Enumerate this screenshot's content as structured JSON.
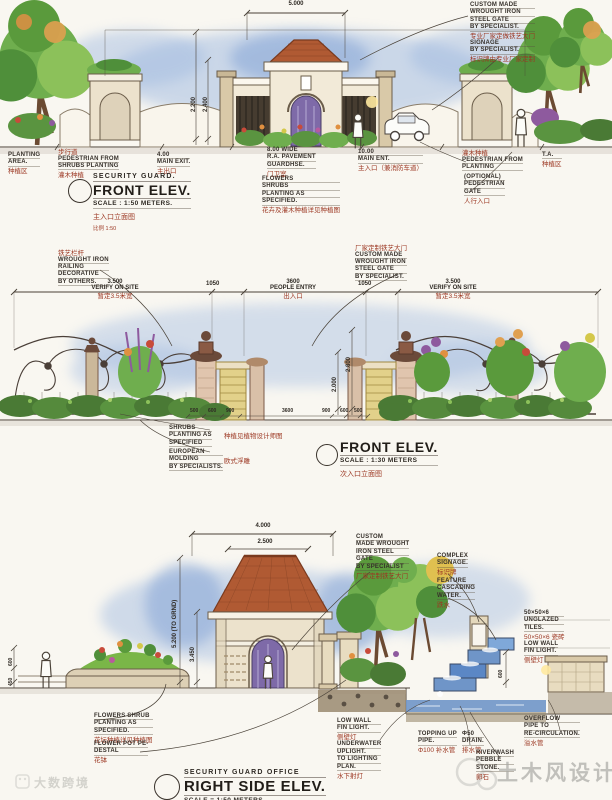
{
  "page": {
    "bg": "#f9f7f1",
    "ink": "#2f2a24",
    "cn_red": "#9c3722",
    "sky_blue": "#9db8e0",
    "roof_terracotta": "#b05a33",
    "foliage_green": "#6fae4e",
    "water_blue": "#6f95c8",
    "stone_yellow": "#e2d18a"
  },
  "watermarks": {
    "bottom_left": "大数跨境",
    "bottom_right": "土木风设计"
  },
  "elevations": [
    {
      "key": "front-elev-main-entrance",
      "title_small": "SECURITY GUARD.",
      "title": "FRONT ELEV.",
      "scale": "SCALE : 1:50 METERS.",
      "caption_cn": "主入口立面图",
      "caption_cn2": "比例 1:50",
      "dims": [
        "5.000",
        "2.200",
        "2.400"
      ],
      "annotations": [
        {
          "lines": [
            {
              "t": "PLANTING",
              "c": "en"
            },
            {
              "t": "AREA.",
              "c": "en"
            },
            {
              "t": "种植区",
              "c": "cn"
            }
          ]
        },
        {
          "lines": [
            {
              "t": "步行道",
              "c": "cn"
            },
            {
              "t": "PEDESTRIAN FROM",
              "c": "en"
            },
            {
              "t": "SHRUBS PLANTING",
              "c": "en"
            },
            {
              "t": "灌木种植",
              "c": "cn"
            }
          ]
        },
        {
          "lines": [
            {
              "t": "4.00",
              "c": "en"
            },
            {
              "t": "MAIN EXIT.",
              "c": "en"
            },
            {
              "t": "主出口",
              "c": "cn"
            }
          ]
        },
        {
          "lines": [
            {
              "t": "8.00 WIDE",
              "c": "en"
            },
            {
              "t": "R.A. PAVEMENT",
              "c": "en"
            },
            {
              "t": "GUARDHSE.",
              "c": "en"
            },
            {
              "t": "门卫室",
              "c": "cn"
            }
          ]
        },
        {
          "lines": [
            {
              "t": "FLOWERS",
              "c": "en"
            },
            {
              "t": "SHRUBS",
              "c": "en"
            },
            {
              "t": "PLANTING AS",
              "c": "en"
            },
            {
              "t": "SPECIFIED.",
              "c": "en"
            },
            {
              "t": "花卉及灌木种植详见种植图",
              "c": "cn"
            }
          ]
        },
        {
          "lines": [
            {
              "t": "10.00",
              "c": "en"
            },
            {
              "t": "MAIN ENT.",
              "c": "en"
            },
            {
              "t": "主入口（兼消防车道）",
              "c": "cn"
            }
          ]
        },
        {
          "lines": [
            {
              "t": "CUSTOM MADE",
              "c": "en"
            },
            {
              "t": "WROUGHT IRON",
              "c": "en"
            },
            {
              "t": "STEEL GATE",
              "c": "en"
            },
            {
              "t": "BY SPECIALIST.",
              "c": "en"
            },
            {
              "t": "专业厂家定做铁艺大门",
              "c": "cn"
            }
          ]
        },
        {
          "lines": [
            {
              "t": "SIGNAGE",
              "c": "en"
            },
            {
              "t": "BY SPECIALIST.",
              "c": "en"
            },
            {
              "t": "标识牌由专业厂家定制",
              "c": "cn"
            }
          ]
        },
        {
          "lines": [
            {
              "t": "灌木种植",
              "c": "cn"
            },
            {
              "t": "PEDESTRIAN FROM",
              "c": "en"
            },
            {
              "t": "PLANTING",
              "c": "en"
            }
          ]
        },
        {
          "lines": [
            {
              "t": "(OPTIONAL)",
              "c": "en"
            },
            {
              "t": "PEDESTRIAN",
              "c": "en"
            },
            {
              "t": "GATE",
              "c": "en"
            },
            {
              "t": "人行入口",
              "c": "cn"
            }
          ]
        },
        {
          "lines": [
            {
              "t": "T.A.",
              "c": "en"
            },
            {
              "t": "种植区",
              "c": "cn"
            }
          ]
        }
      ]
    },
    {
      "key": "front-elev-secondary-entrance",
      "title": "FRONT ELEV.",
      "scale": "SCALE : 1:30 METERS",
      "caption_cn": "次入口立面图",
      "dims": [
        "2.800",
        "2.000",
        "500",
        "600",
        "900",
        "3600",
        "900",
        "600",
        "500"
      ],
      "annotations": [
        {
          "lines": [
            {
              "t": "铁艺栏杆",
              "c": "cn"
            },
            {
              "t": "WROUGHT IRON",
              "c": "en"
            },
            {
              "t": "RAILING",
              "c": "en"
            },
            {
              "t": "DECORATIVE",
              "c": "en"
            },
            {
              "t": "BY OTHERS.",
              "c": "en"
            }
          ]
        },
        {
          "lines": [
            {
              "t": "3.500",
              "c": "dimc"
            },
            {
              "t": "VERIFY ON SITE",
              "c": "dimc"
            },
            {
              "t": "暂定3.5米宽",
              "c": "cn"
            }
          ]
        },
        {
          "lines": [
            {
              "t": "1050",
              "c": "dimc"
            }
          ]
        },
        {
          "lines": [
            {
              "t": "3600",
              "c": "dimc"
            },
            {
              "t": "PEOPLE ENTRY",
              "c": "dimc"
            },
            {
              "t": "出入口",
              "c": "cn"
            }
          ]
        },
        {
          "lines": [
            {
              "t": "1050",
              "c": "dimc"
            }
          ]
        },
        {
          "lines": [
            {
              "t": "3.500",
              "c": "dimc"
            },
            {
              "t": "VERIFY ON SITE",
              "c": "dimc"
            },
            {
              "t": "暂定3.5米宽",
              "c": "cn"
            }
          ]
        },
        {
          "lines": [
            {
              "t": "厂家定制铁艺大门",
              "c": "cn"
            },
            {
              "t": "CUSTOM MADE",
              "c": "en"
            },
            {
              "t": "WROUGHT IRON",
              "c": "en"
            },
            {
              "t": "STEEL GATE",
              "c": "en"
            },
            {
              "t": "BY SPECIALIST.",
              "c": "en"
            }
          ]
        },
        {
          "lines": [
            {
              "t": "SHRUBS",
              "c": "en"
            },
            {
              "t": "PLANTING AS",
              "c": "en"
            },
            {
              "t": "SPECIFIED",
              "c": "en"
            }
          ]
        },
        {
          "lines": [
            {
              "t": "种植见植物设计师图",
              "c": "cn"
            }
          ]
        },
        {
          "lines": [
            {
              "t": "EUROPEAN",
              "c": "en"
            },
            {
              "t": "MOLDING",
              "c": "en"
            },
            {
              "t": "BY SPECIALISTS.",
              "c": "en"
            }
          ]
        },
        {
          "lines": [
            {
              "t": "欧式浮雕",
              "c": "cn"
            }
          ]
        }
      ]
    },
    {
      "key": "right-side-elev-guard-office",
      "title_small": "SECURITY GUARD  OFFICE",
      "title": "RIGHT SIDE ELEV.",
      "scale": "SCALE = 1:50 METERS",
      "dims": [
        "4.000",
        "2.500",
        "5.200 (TO GRND)",
        "3.450",
        "600",
        "450",
        "600"
      ],
      "annotations": [
        {
          "lines": [
            {
              "t": "CUSTOM",
              "c": "en"
            },
            {
              "t": "MADE WROUGHT",
              "c": "en"
            },
            {
              "t": "IRON STEEL",
              "c": "en"
            },
            {
              "t": "GATE",
              "c": "en"
            },
            {
              "t": "BY SPECIALIST",
              "c": "en"
            },
            {
              "t": "厂家定制铁艺大门",
              "c": "cn"
            }
          ]
        },
        {
          "lines": [
            {
              "t": "COMPLEX",
              "c": "en"
            },
            {
              "t": "SIGNAGE.",
              "c": "en"
            },
            {
              "t": "标识牌",
              "c": "cn"
            }
          ]
        },
        {
          "lines": [
            {
              "t": "FEATURE",
              "c": "en"
            },
            {
              "t": "CASCADING",
              "c": "en"
            },
            {
              "t": "WATER.",
              "c": "en"
            },
            {
              "t": "跌水",
              "c": "cn"
            }
          ]
        },
        {
          "lines": [
            {
              "t": "50×50×6",
              "c": "en"
            },
            {
              "t": "UNGLAZED",
              "c": "en"
            },
            {
              "t": "TILES.",
              "c": "en"
            },
            {
              "t": "50×50×6 瓷砖",
              "c": "cn"
            }
          ]
        },
        {
          "lines": [
            {
              "t": "LOW WALL",
              "c": "en"
            },
            {
              "t": "FIN LIGHT.",
              "c": "en"
            },
            {
              "t": "侧壁灯",
              "c": "cn"
            }
          ]
        },
        {
          "lines": [
            {
              "t": "FLOWERS SHRUB",
              "c": "en"
            },
            {
              "t": "PLANTING AS",
              "c": "en"
            },
            {
              "t": "SPECIFIED.",
              "c": "en"
            },
            {
              "t": "花坛种植详见种植图",
              "c": "cn"
            }
          ]
        },
        {
          "lines": [
            {
              "t": "FLOWER POT PE-",
              "c": "en"
            },
            {
              "t": "DESTAL",
              "c": "en"
            },
            {
              "t": "花钵",
              "c": "cn"
            }
          ]
        },
        {
          "lines": [
            {
              "t": "LOW WALL",
              "c": "en"
            },
            {
              "t": "FIN LIGHT.",
              "c": "en"
            },
            {
              "t": "侧壁灯",
              "c": "cn"
            },
            {
              "t": "UNDERWATER",
              "c": "en"
            },
            {
              "t": "UPLIGHT.",
              "c": "en"
            },
            {
              "t": "TO LIGHTING",
              "c": "en"
            },
            {
              "t": "PLAN.",
              "c": "en"
            },
            {
              "t": "水下射灯",
              "c": "cn"
            }
          ]
        },
        {
          "lines": [
            {
              "t": "TOPPING UP",
              "c": "en"
            },
            {
              "t": "PIPE.",
              "c": "en"
            },
            {
              "t": "Φ100 补水管",
              "c": "cn"
            }
          ]
        },
        {
          "lines": [
            {
              "t": "Φ50",
              "c": "en"
            },
            {
              "t": "DRAIN.",
              "c": "en"
            },
            {
              "t": "排水管",
              "c": "cn"
            }
          ]
        },
        {
          "lines": [
            {
              "t": "RIVERWASH",
              "c": "en"
            },
            {
              "t": "PEBBLE",
              "c": "en"
            },
            {
              "t": "STONE.",
              "c": "en"
            },
            {
              "t": "卵石",
              "c": "cn"
            }
          ]
        },
        {
          "lines": [
            {
              "t": "OVERFLOW",
              "c": "en"
            },
            {
              "t": "PIPE TO",
              "c": "en"
            },
            {
              "t": "RE-CIRCULATION.",
              "c": "en"
            },
            {
              "t": "溢水管",
              "c": "cn"
            }
          ]
        }
      ]
    }
  ]
}
